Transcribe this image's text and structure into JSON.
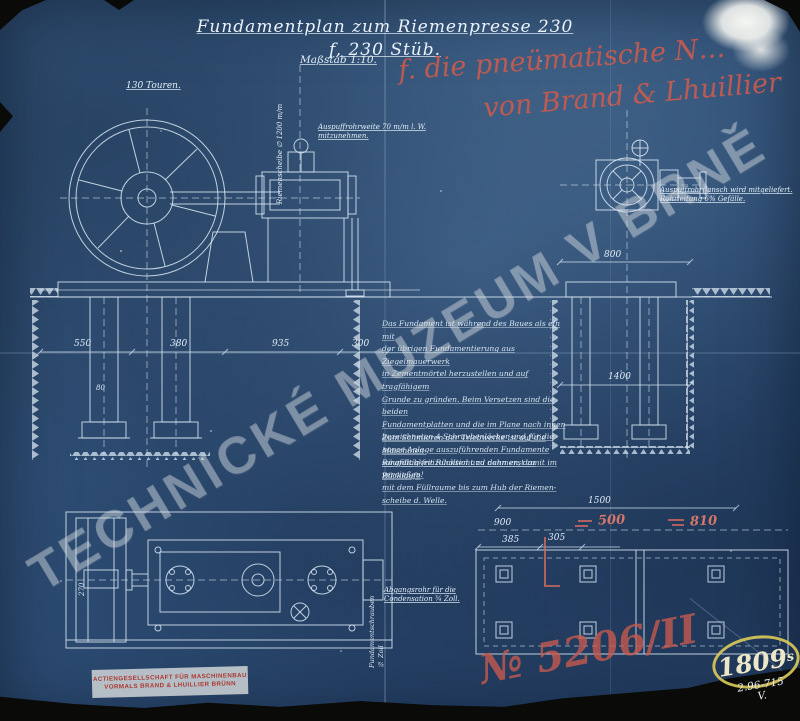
{
  "document": {
    "title": "Fundamentplan zum Riemenpresse 230 f, 230 Stüb.",
    "scale_note": "Maßstab 1:10."
  },
  "red_annotation": {
    "line1": "f. die pneümatische N…",
    "line2": "von Brand & Lhuillier"
  },
  "watermark": {
    "text": "TECHNICKÉ MUZEUM V BRNĚ"
  },
  "labels": {
    "touren": "130 Touren.",
    "riemenscheibe": "Riemenscheibe ∅ 1200 m/m",
    "auspuff": "Auspuffrohrweite 70 m/m l. W.\nmitzunehmen.",
    "right_machine": "Auspuffrohrflansch wird mitgeliefert.\nRohrleitung 6% Gefälle.",
    "abgang": "Abgangsrohr für die\nCondensation ¾ Zoll.",
    "fundament_schrauben": "Fundamentschrauben ¾ Zoll"
  },
  "notes": {
    "para1": "Das Fundament ist während des Baues als ein mit\nder übrigen Fundamentierung aus Ziegelmauerwerk\nin Zementmörtel herzustellen und auf tragfähigem\nGrunde zu gründen. Beim Versetzen sind die beiden\nFundamentplatten und die im Plane nach innen\nbezeichneten 4 Schraubenlöcher und für die\nganze Anlage auszuführenden Fundamente\nsorgfältig freizuhalten und dann erst zu vergießen!",
    "para2": "Zum Schmieren der Triebwerke ist auf die Maschinen-\nRäumlichkeit Rücksicht zu nehmen, damit im Rücklaufe\nmit dem Füllraume bis zum Hub der Riemen-\nscheibe d. Welle."
  },
  "dimensions": {
    "left_d1": "550",
    "left_d2": "380",
    "left_d3": "935",
    "left_d4": "300",
    "left_small": "80",
    "left_vert": "270",
    "right_a": "800",
    "right_b": "1400",
    "plan_top": "1500",
    "plan_left": "900",
    "plan_d1": "385",
    "plan_d2": "305",
    "plan_red1": "500",
    "plan_red2": "810"
  },
  "stamp": {
    "line1": "ACTIENGESELLSCHAFT FÜR MASCHINENBAU",
    "line2": "VORMALS BRAND & LHUILLIER BRÜNN"
  },
  "registry": {
    "number_red": "№ 5206/II",
    "inventory": "1809",
    "inventory_sub": "s",
    "archive_code": "2.96-715\nV."
  },
  "colors": {
    "paper_blue": "#2f5077",
    "ink_white": "#dce9f5",
    "red_ink": "#c95a4e",
    "yellow_ink": "#d8c858"
  }
}
